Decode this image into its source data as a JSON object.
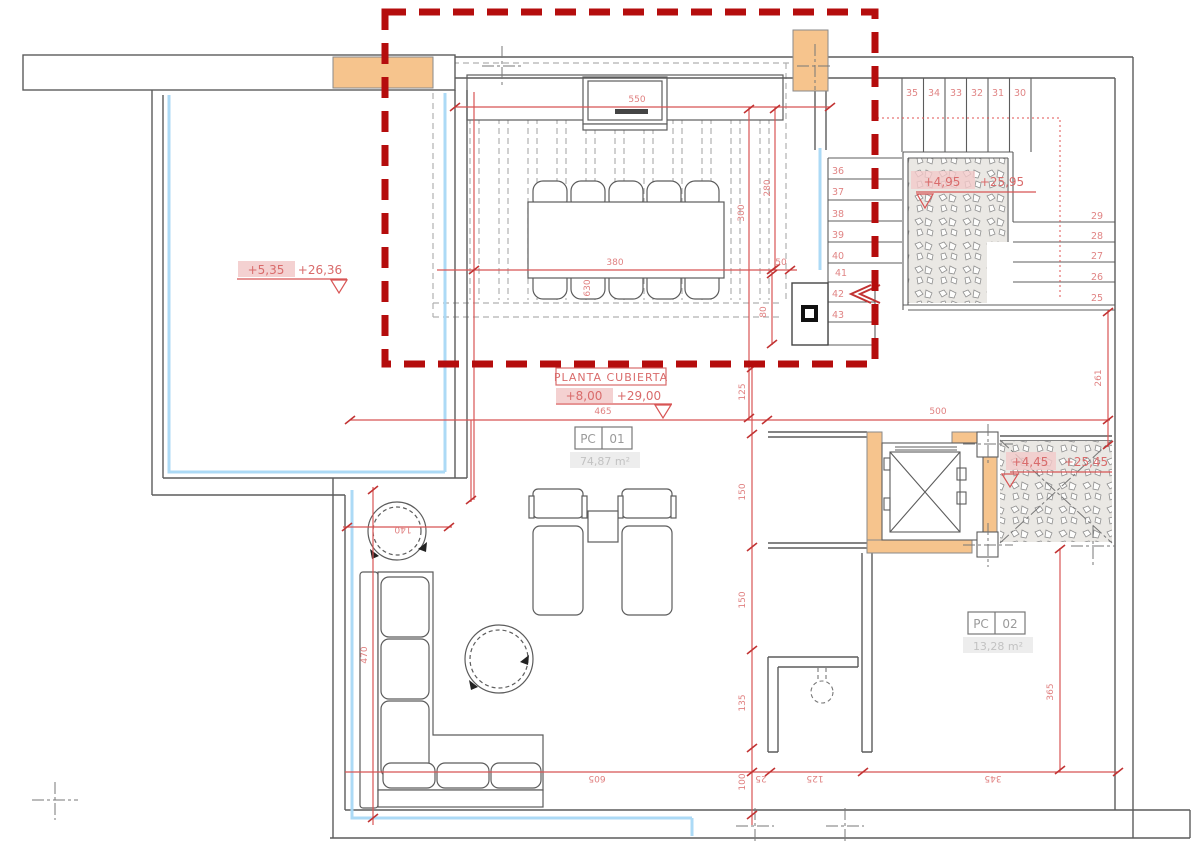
{
  "title_box": {
    "title": "PLANTA CUBIERTA",
    "level_main": "+8,00",
    "level_alt": "+29,00"
  },
  "levels": {
    "terrace_main": "+5,35",
    "terrace_alt": "+26,36",
    "stair_main": "+4,95",
    "stair_alt": "+25,95",
    "lift_main": "+4,45",
    "lift_alt": "+25,45"
  },
  "rooms": {
    "pc01": {
      "code": "PC",
      "num": "01",
      "area": "74,87 m²"
    },
    "pc02": {
      "code": "PC",
      "num": "02",
      "area": "13,28 m²"
    }
  },
  "stairs": {
    "upper": [
      "35",
      "34",
      "33",
      "32",
      "31",
      "30"
    ],
    "left": [
      "36",
      "37",
      "38",
      "39",
      "40",
      "41",
      "42",
      "43"
    ],
    "right": [
      "29",
      "28",
      "27",
      "26",
      "25"
    ]
  },
  "dims": {
    "counter": "550",
    "table_zone": "380",
    "offset50": "50",
    "span_left": "465",
    "span_right": "500",
    "v630": "630",
    "v300": "300",
    "v280": "280",
    "v80": "80",
    "c125": "125",
    "c150a": "150",
    "c150b": "150",
    "c135": "135",
    "c100": "100",
    "sofa470": "470",
    "table140": "140",
    "bottom605": "605",
    "b25": "25",
    "b125": "125",
    "b345": "345",
    "right365": "365",
    "stair261": "261"
  },
  "colors": {
    "dim_red": "#d85555",
    "label_red": "#e08080",
    "selection_red": "#b50d0d",
    "orange": "#f6c48d",
    "blue": "#a8d8f5",
    "wall_gray": "#5c5c5c",
    "pink": "#f2c9c9"
  }
}
